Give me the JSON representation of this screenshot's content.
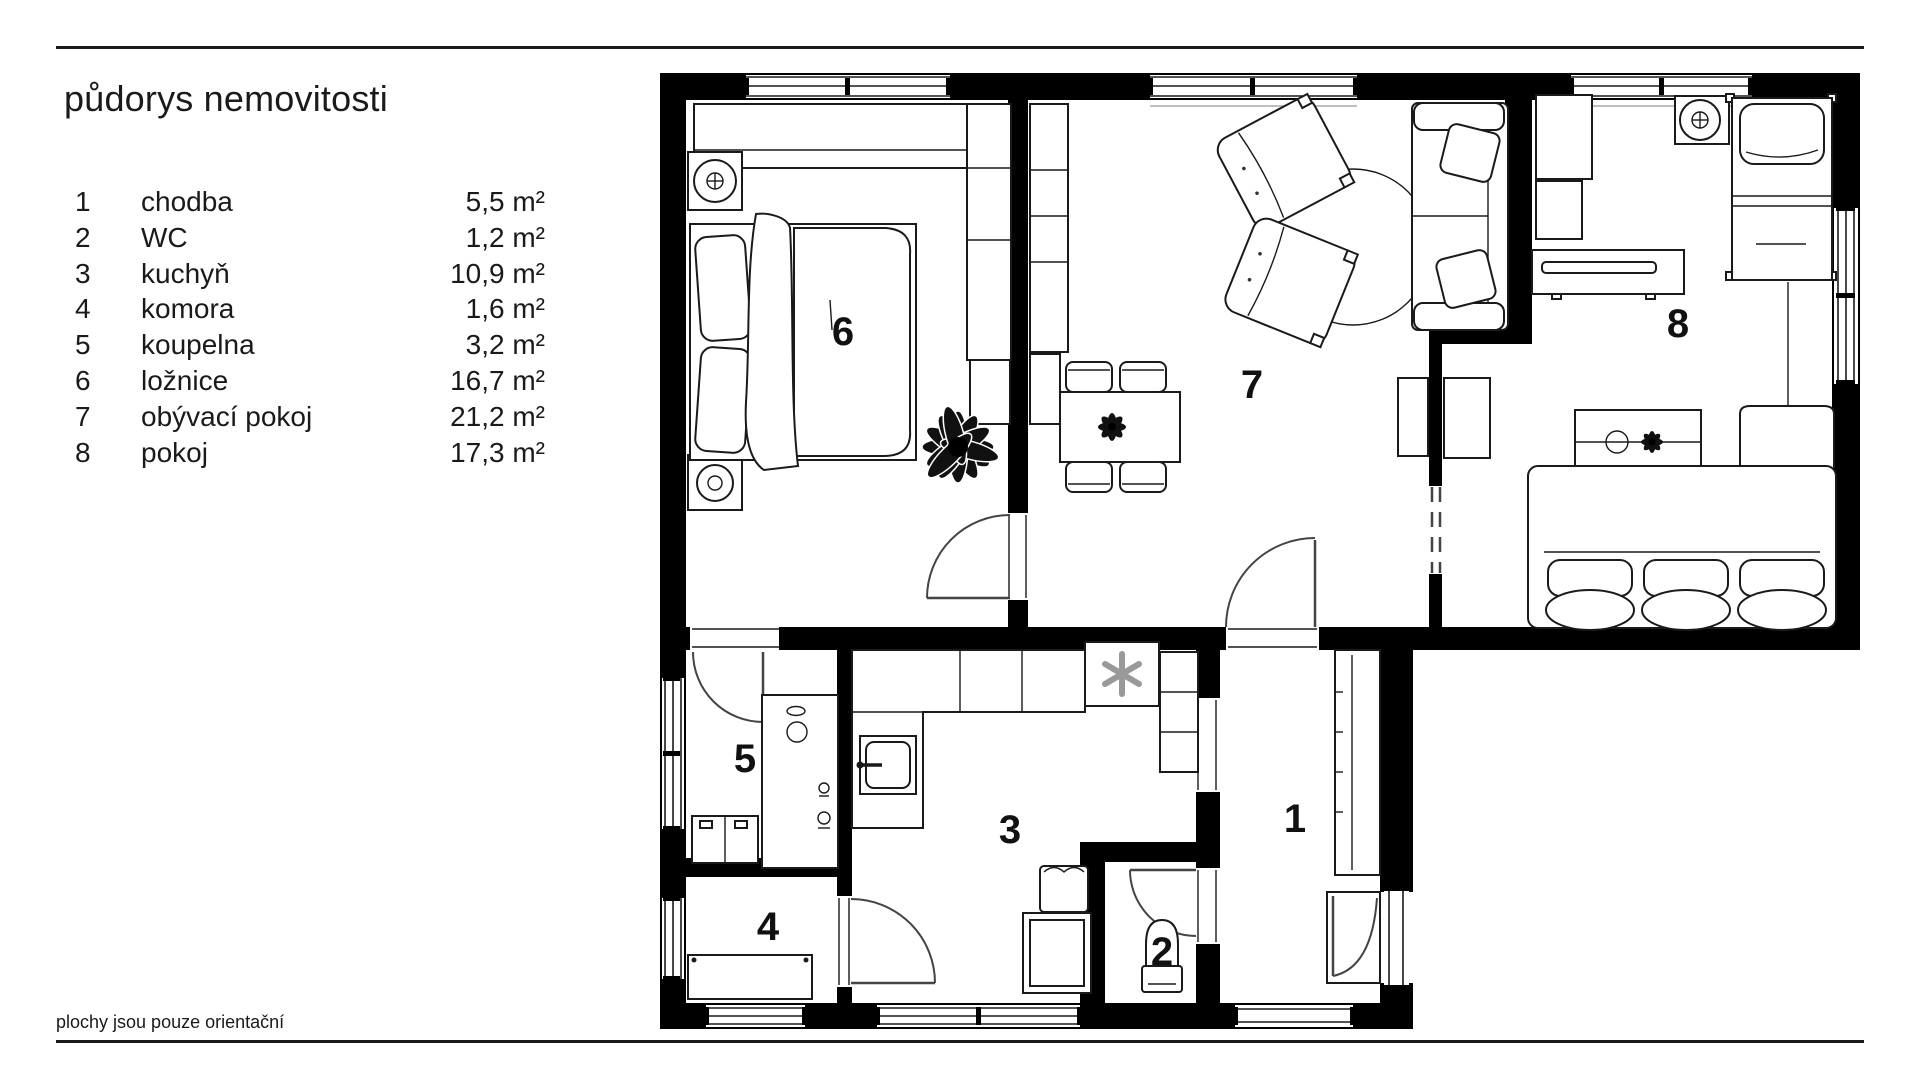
{
  "header": {
    "title": "půdorys nemovitosti"
  },
  "legend": {
    "rooms": [
      {
        "num": "1",
        "name": "chodba",
        "area": "5,5 m²"
      },
      {
        "num": "2",
        "name": "WC",
        "area": "1,2 m²"
      },
      {
        "num": "3",
        "name": "kuchyň",
        "area": "10,9 m²"
      },
      {
        "num": "4",
        "name": "komora",
        "area": "1,6 m²"
      },
      {
        "num": "5",
        "name": "koupelna",
        "area": "3,2 m²"
      },
      {
        "num": "6",
        "name": "ložnice",
        "area": "16,7 m²"
      },
      {
        "num": "7",
        "name": "obývací pokoj",
        "area": "21,2 m²"
      },
      {
        "num": "8",
        "name": "pokoj",
        "area": "17,3 m²"
      }
    ]
  },
  "footer": {
    "note": "plochy jsou pouze orientační"
  },
  "floorplan": {
    "colors": {
      "wall": "#000000",
      "line": "#1a1a1a",
      "background": "#ffffff"
    },
    "labels": [
      "1",
      "2",
      "3",
      "4",
      "5",
      "6",
      "7",
      "8"
    ]
  }
}
